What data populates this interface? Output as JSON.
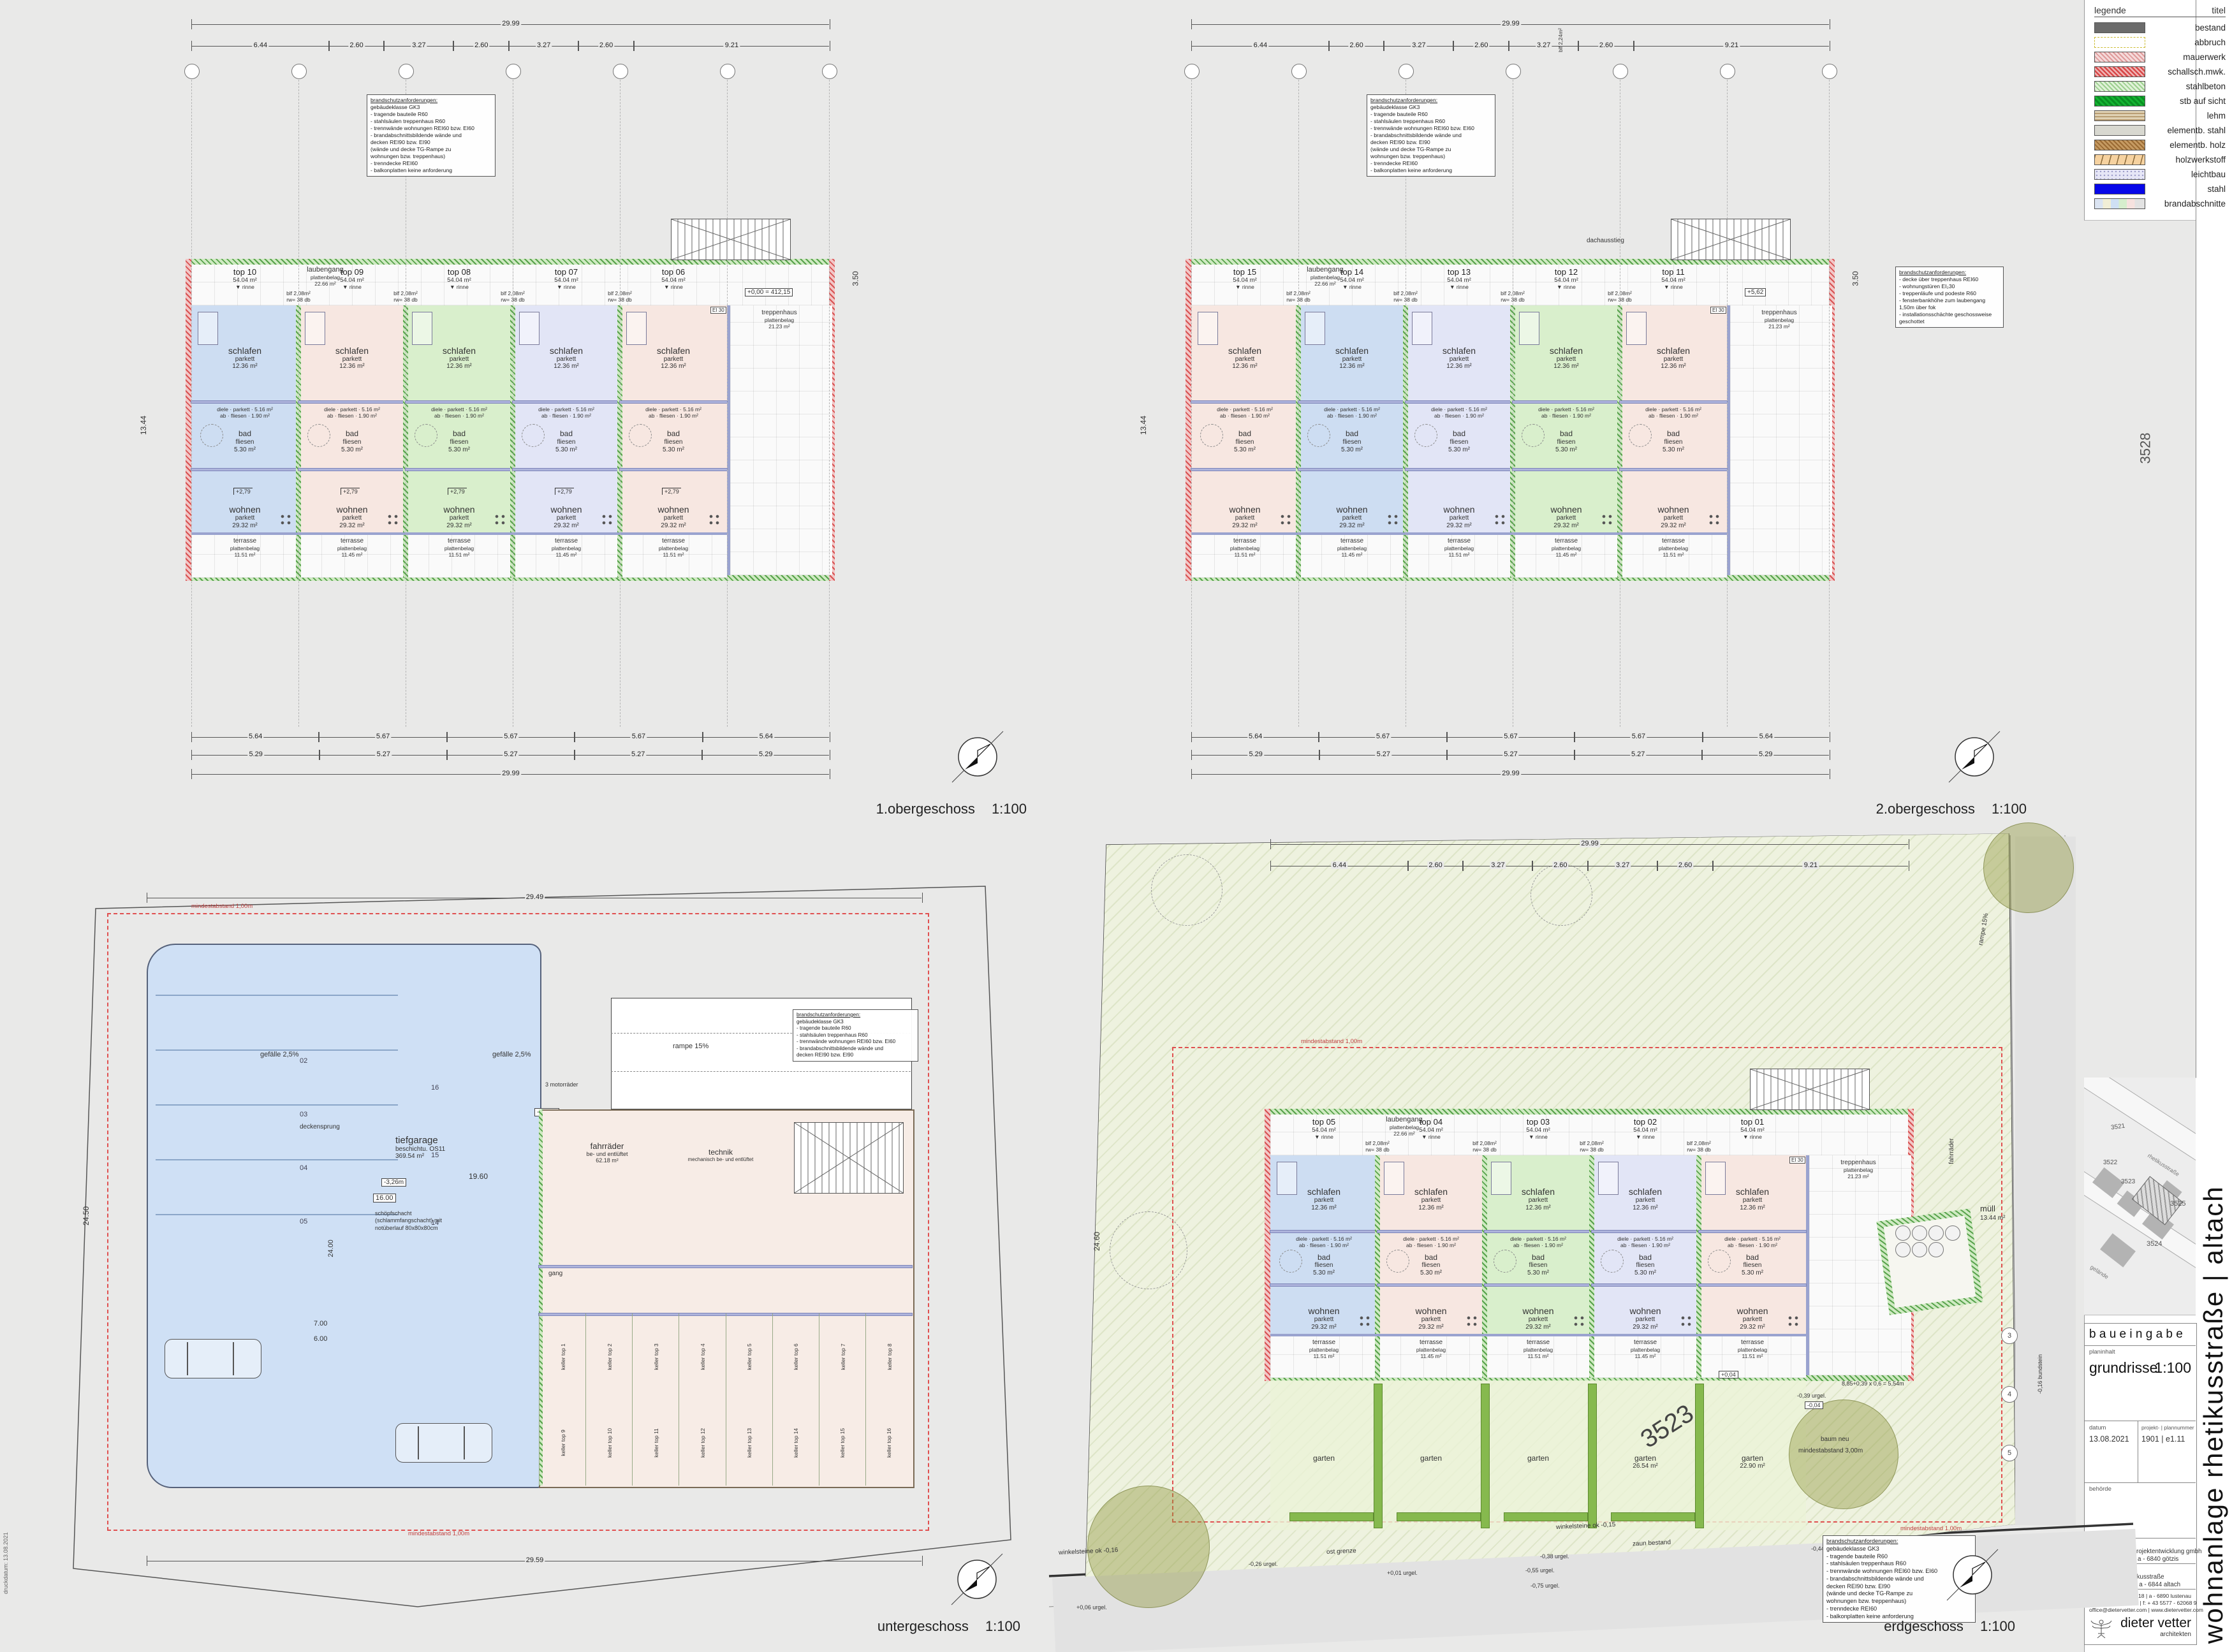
{
  "sheet": {
    "print_note": "druckdatum: 13.08.2021",
    "vertical_title": "wohnanlage rhetikusstraße  |  altach"
  },
  "legend": {
    "title": "legende",
    "column_header": "titel",
    "items": [
      {
        "key": "bestand",
        "label": "bestand"
      },
      {
        "key": "abbruch",
        "label": "abbruch"
      },
      {
        "key": "mauerwerk",
        "label": "mauerwerk"
      },
      {
        "key": "schallschmwk",
        "label": "schallsch.mwk."
      },
      {
        "key": "stahlbeton",
        "label": "stahlbeton"
      },
      {
        "key": "stbaufsicht",
        "label": "stb auf sicht"
      },
      {
        "key": "lehm",
        "label": "lehm"
      },
      {
        "key": "elementbstahl",
        "label": "elementb. stahl"
      },
      {
        "key": "elementbholz",
        "label": "elementb. holz"
      },
      {
        "key": "holzwerkstoff",
        "label": "holzwerkstoff"
      },
      {
        "key": "leichtbau",
        "label": "leichtbau"
      },
      {
        "key": "stahl",
        "label": "stahl"
      },
      {
        "key": "brandabschnitte",
        "label": "brandabschnitte"
      }
    ]
  },
  "title_block": {
    "header": "b a u e i n g a b e",
    "planinhalt_label": "planinhalt",
    "planinhalt": "grundrisse",
    "scale": "1:100",
    "datum_label": "datum",
    "datum": "13.08.2021",
    "projekt_nr_label": "projekt-  |  plannummer",
    "projekt_nr": "1901  |  e1.11",
    "behoerde_label": "behörde",
    "bauherr_label": "bauherr",
    "bauherr_line1": "bmu immobilienprojektentwicklung gmbh",
    "bauherr_line2": "am gammarkt 3 | a - 6840 götzis",
    "projekt_label": "projekt",
    "projekt_line1": "wohnanlage rhetikusstraße",
    "projekt_line2": "rhetikusstraße 5  |  a - 6844 altach",
    "address": "raiffeisenstraße 18  |  a - 6890 lustenau",
    "phone": "t: + 43 5577 - 62068  |  f: + 43 5577 - 62068 9",
    "web": "office@dietervetter.com  |  www.dietervetter.com",
    "firm": "dieter vetter",
    "firm_sub": "architekten"
  },
  "location_map": {
    "parcels": [
      "3521",
      "3522",
      "3523",
      "3524",
      "3525"
    ],
    "street": "rhetikusstraße",
    "area_label": "gelände"
  },
  "fire_notes": {
    "title": "brandschutzanforderungen:",
    "block_a": [
      "gebäudeklasse GK3",
      "- tragende bauteile R60",
      "- stahlsäulen treppenhaus R60",
      "- trennwände wohnungen REI60 bzw. EI60",
      "- brandabschnittsbildende wände und",
      "  decken REI90 bzw. EI90",
      "  (wände und decke TG-Rampe zu",
      "  wohnungen bzw. treppenhaus)",
      "- trenndecke REI60",
      "- balkonplatten keine anforderung"
    ],
    "block_b": [
      "- decke über treppenhaus REI60",
      "- wohnungstüren EI₂30",
      "- treppenläufe und podeste R60",
      "- fensterbankhöhe zum laubengang",
      "  1,50m über fok",
      "- installationsschächte geschossweise",
      "  geschottet"
    ]
  },
  "unit_rooms": {
    "schlafen": {
      "name": "schlafen",
      "finish": "parkett",
      "area": "12.36 m²"
    },
    "diele": {
      "name": "diele",
      "finish": "parkett",
      "area": "5.16 m²"
    },
    "ab": {
      "name": "ab",
      "finish": "fliesen",
      "area": "1.90 m²"
    },
    "bad": {
      "name": "bad",
      "finish": "fliesen",
      "area": "5.30 m²"
    },
    "wohnen": {
      "name": "wohnen",
      "finish": "parkett",
      "area": "29.32 m²"
    }
  },
  "walkway": {
    "name": "laubengang",
    "finish": "plattenbelag",
    "area": "22.66 m²",
    "drain": "▼ rinne",
    "blf": "blf 2,08m²",
    "blf2": "blf 2,24m²",
    "rw": "rw= 38 db"
  },
  "stair": {
    "name": "treppenhaus",
    "finish": "plattenbelag",
    "area": "21.23 m²",
    "roof_access": "dachausstieg",
    "door_tag": "EI 30"
  },
  "terrace": {
    "name": "terrasse",
    "finish": "plattenbelag",
    "areas": [
      "11.51 m²",
      "11.45 m²",
      "11.51 m²",
      "11.45 m²",
      "11.51 m²"
    ]
  },
  "plans": {
    "og1": {
      "title": "1.obergeschoss",
      "scale": "1:100",
      "units": [
        "top 10",
        "top 09",
        "top 08",
        "top 07",
        "top 06"
      ],
      "unit_area": "54.04 m²",
      "levels": {
        "box": "+0,00 = 412,15",
        "floor": "+2,79"
      },
      "dims": {
        "top_total": "29.99",
        "top_segments": [
          "6.44",
          "2.60",
          "3.27",
          "2.60",
          "3.27",
          "2.60",
          "9.21"
        ],
        "bottom_segments": [
          "5.29",
          "5.27",
          "5.27",
          "5.27",
          "5.29"
        ],
        "bottom_segments2": [
          "5.64",
          "5.67",
          "5.67",
          "5.67",
          "5.64"
        ],
        "bottom_total": "29.99",
        "left": "13.44",
        "right": "3.50"
      }
    },
    "og2": {
      "title": "2.obergeschoss",
      "scale": "1:100",
      "units": [
        "top 15",
        "top 14",
        "top 13",
        "top 12",
        "top 11"
      ],
      "unit_area": "54.04 m²",
      "levels": {
        "box": "+5,62",
        "floor": "+5,62"
      },
      "dims": {
        "top_total": "29.99",
        "top_segments": [
          "6.44",
          "2.60",
          "3.27",
          "2.60",
          "3.27",
          "2.60",
          "9.21"
        ],
        "bottom_segments": [
          "5.29",
          "5.27",
          "5.27",
          "5.27",
          "5.29"
        ],
        "bottom_segments2": [
          "5.64",
          "5.67",
          "5.67",
          "5.67",
          "5.64"
        ],
        "bottom_total": "29.99",
        "left": "13.44",
        "right": "3.50"
      }
    },
    "ug": {
      "title": "untergeschoss",
      "scale": "1:100",
      "garage": {
        "name": "tiefgarage",
        "sub": "beschichtu. OS11",
        "area": "369.54 m²"
      },
      "rooms": {
        "fahrraeder": {
          "name": "fahrräder",
          "sub": "be- und entlüftet",
          "area": "62.18 m²"
        },
        "technik": {
          "name": "technik",
          "sub": "mechanisch be- und entlüftet"
        },
        "gang": {
          "name": "gang"
        }
      },
      "keller_row1": [
        "keller top 1",
        "keller top 2",
        "keller top 3",
        "keller top 4",
        "keller top 5",
        "keller top 6",
        "keller top 7",
        "keller top 8"
      ],
      "keller_row2": [
        "keller top 9",
        "keller top 10",
        "keller top 11",
        "keller top 12",
        "keller top 13",
        "keller top 14",
        "keller top 15",
        "keller top 16"
      ],
      "parking_numbers": [
        "02",
        "03",
        "04",
        "05",
        "16",
        "15",
        "14"
      ],
      "annotations": {
        "schacht": "schöpfschacht (schlammfangschacht) mit notüberlauf 80x80x80cm",
        "deckensprung": "deckensprung",
        "gefaelle": "gefälle 2,5%",
        "rampe15": "rampe 15%",
        "rampe5": "rampe 5%",
        "motorraeder": "3 motorräder",
        "level": "-3,26m",
        "level2": "-3,06m",
        "d16": "16.00",
        "d19": "19.60",
        "d24": "24.00",
        "d7": "7.00",
        "d6": "6.00",
        "d5": "5.00",
        "mindest": "mindestabstand 1,00m"
      },
      "dims": {
        "top_total": "29.49",
        "bottom_total": "29.59",
        "left": "24.50"
      }
    },
    "eg": {
      "title": "erdgeschoss",
      "scale": "1:100",
      "units": [
        "top 05",
        "top 04",
        "top 03",
        "top 02",
        "top 01"
      ],
      "unit_area": "54.04 m²",
      "parcel": "3523",
      "parcel2": "3528",
      "gardens": [
        {
          "name": "garten",
          "area": ""
        },
        {
          "name": "garten",
          "area": ""
        },
        {
          "name": "garten",
          "area": ""
        },
        {
          "name": "garten",
          "area": "26.54 m²"
        },
        {
          "name": "garten",
          "area": "22.90 m²"
        }
      ],
      "grid_bubbles": [
        "3",
        "4",
        "5"
      ],
      "annotations": {
        "muell": "müll",
        "muell_area": "13.44 m²",
        "baum_neu": "baum neu",
        "mindest3": "mindestabstand 3,00m",
        "mindest1": "mindestabstand 1,00m",
        "winkel1": "winkelsteine ok -0,15",
        "winkel2": "winkelsteine ok -0,16",
        "zaun": "zaun bestand",
        "grenze": "ost grenze",
        "formula": "8,85+0,39 x 0,6 = 5,54m",
        "rampe": "rampe 15%",
        "fahrraeder": "fahrräder",
        "bundstein": "-0,16 bundstein",
        "lvl_p004": "+0,04",
        "lvl_m004": "-0,04",
        "urgel": [
          "+0,01 urgel.",
          "-0,26 urgel.",
          "-0,38 urgel.",
          "-0,44 urgel.",
          "-0,55 urgel.",
          "-0,75 urgel.",
          "+0,06 urgel.",
          "-0,39 urgel."
        ]
      },
      "dims": {
        "top_total": "29.99",
        "top_segments": [
          "6.44",
          "2.60",
          "3.27",
          "2.60",
          "3.27",
          "2.60",
          "9.21"
        ],
        "left": "24.60"
      }
    }
  }
}
